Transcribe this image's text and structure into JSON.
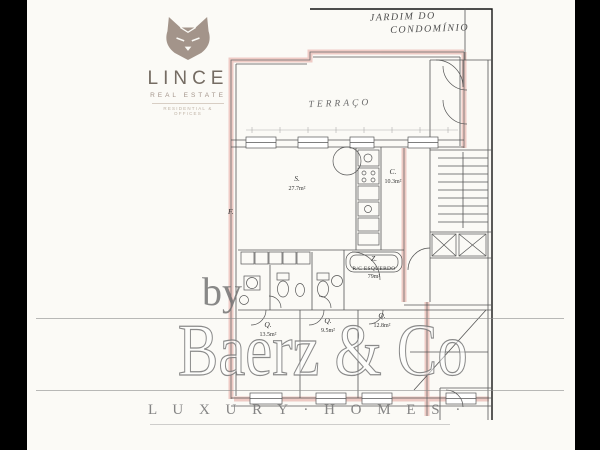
{
  "logo": {
    "brand": "LINCE",
    "tagline": "REAL ESTATE",
    "subtagline": "RESIDENTIAL & OFFICES",
    "color": "#a3948a"
  },
  "handwritten": {
    "garden_line1": "JARDIM DO",
    "garden_line2": "CONDOMÍNIO",
    "terrace": "TERRAÇO"
  },
  "plan": {
    "wall_highlight_color": "#ecc2bc",
    "line_color": "#565656",
    "labels": {
      "living": {
        "name": "S.",
        "area": "27.7m²"
      },
      "kitchen": {
        "name": "C.",
        "area": "10.3m²"
      },
      "hall": {
        "name": "Z.",
        "caption": "R/C ESQUERDO",
        "area": "79m²"
      },
      "facade": "F.",
      "bedroom1": {
        "name": "Q.",
        "area": "13.5m²"
      },
      "bedroom2": {
        "name": "Q.",
        "area": "9.5m²"
      },
      "bedroom3": {
        "name": "Q.",
        "area": "12.8m²"
      }
    }
  },
  "watermark": {
    "prefix": "by",
    "brand": "Baerz & Co",
    "tagline": "L U X U R Y · H O M E S ·",
    "color": "#9a9a9a"
  }
}
